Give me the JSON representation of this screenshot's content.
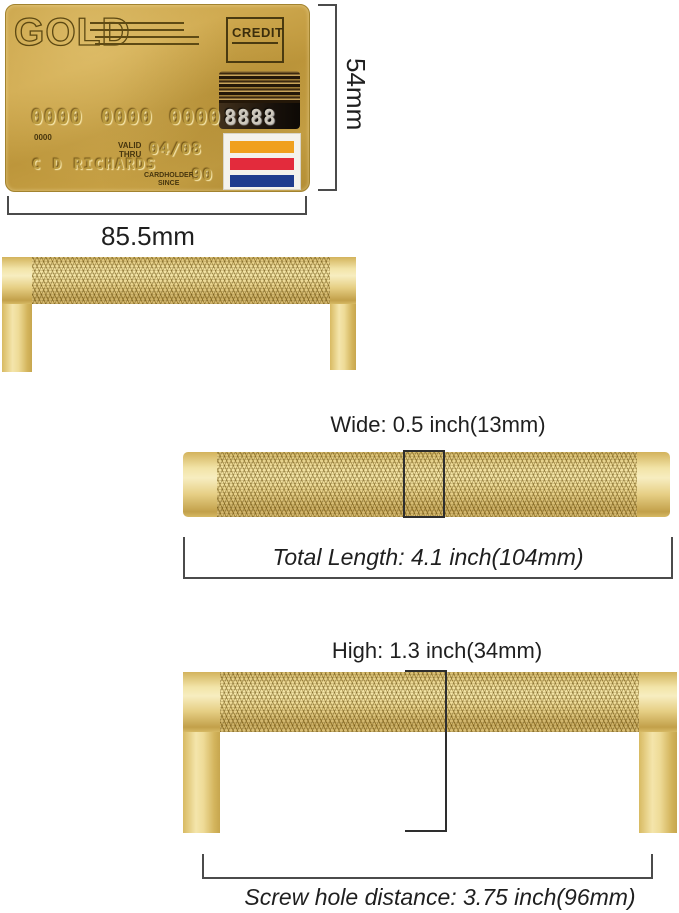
{
  "card": {
    "brand": "GOLD",
    "credit_label": "CREDIT",
    "number_groups": [
      "0000",
      "0000",
      "0000"
    ],
    "stripe_number": "8888",
    "small_number": "0000",
    "valid_label_line1": "VALID",
    "valid_label_line2": "THRU",
    "valid_thru_value": "04/08",
    "cardholder_name": "C D RICHARDS",
    "since_label_line1": "CARDHOLDER",
    "since_label_line2": "SINCE",
    "since_value": "90",
    "flag_colors": {
      "top": "#F0A01E",
      "middle": "#E32B3C",
      "bottom": "#1F3C8E"
    }
  },
  "measurements": {
    "card_height": "54mm",
    "card_width": "85.5mm",
    "handle_width": "Wide: 0.5 inch(13mm)",
    "total_length": "Total Length: 4.1 inch(104mm)",
    "handle_height": "High: 1.3 inch(34mm)",
    "screw_hole_distance": "Screw hole distance: 3.75 inch(96mm)"
  },
  "colors": {
    "handle_gold": "#E7CF82",
    "card_gold": "#C49F43",
    "dimension_line": "#4B4B4B"
  }
}
